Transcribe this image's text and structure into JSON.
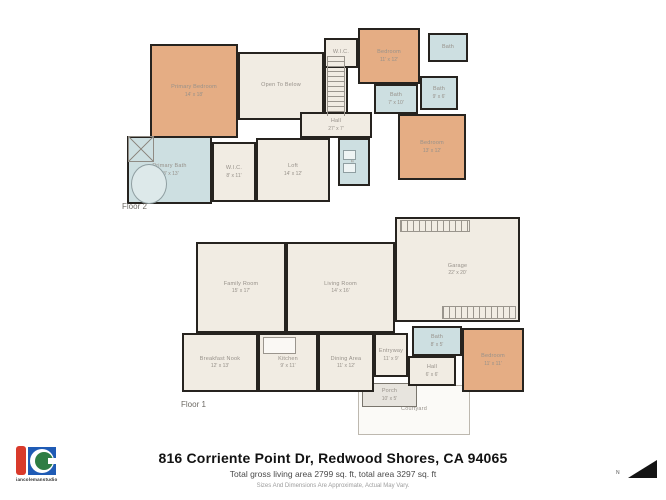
{
  "colors": {
    "wall": "#26231f",
    "bedroom": "#e5ad84",
    "bath": "#cddfe1",
    "common": "#f1ece3",
    "porch": "#e7e4de",
    "outdoor": "#fbfaf7",
    "label": "#97918a",
    "brand_red": "#d93a2b",
    "brand_blue": "#1f5bb5",
    "brand_green": "#2e7d44"
  },
  "title_block": {
    "address": "816 Corriente Point Dr, Redwood Shores, CA 94065",
    "area_line": "Total gross living area 2799 sq. ft, total area 3297 sq. ft",
    "disclaimer": "Sizes And Dimensions Are Approximate, Actual May Vary."
  },
  "branding": {
    "logo_text": "iancolemanstudio"
  },
  "compass": {
    "label": "N"
  },
  "floors": [
    {
      "id": "floor-2",
      "label": "Floor 2",
      "label_pos": [
        122,
        202
      ],
      "rooms": [
        {
          "id": "primary-bedroom",
          "name": "Primary Bedroom",
          "dims": "14' x 18'",
          "type": "bedroom",
          "rect": [
            150,
            44,
            88,
            94
          ]
        },
        {
          "id": "open-to-below",
          "name": "Open To Below",
          "dims": "",
          "type": "common",
          "rect": [
            238,
            52,
            86,
            68
          ]
        },
        {
          "id": "wic-top",
          "name": "W.I.C.",
          "dims": "",
          "type": "common",
          "rect": [
            324,
            38,
            34,
            30
          ]
        },
        {
          "id": "stair-well",
          "name": "",
          "dims": "",
          "type": "common",
          "rect": [
            324,
            66,
            24,
            54
          ]
        },
        {
          "id": "bedroom-2",
          "name": "Bedroom",
          "dims": "11' x 12'",
          "type": "bedroom",
          "rect": [
            358,
            28,
            62,
            56
          ]
        },
        {
          "id": "bath-top-right",
          "name": "Bath",
          "dims": "",
          "type": "bath",
          "rect": [
            428,
            33,
            40,
            29
          ]
        },
        {
          "id": "bath-left",
          "name": "Bath",
          "dims": "7' x 10'",
          "type": "bath",
          "rect": [
            374,
            84,
            44,
            30
          ]
        },
        {
          "id": "bath-right",
          "name": "Bath",
          "dims": "9' x 6'",
          "type": "bath",
          "rect": [
            420,
            76,
            38,
            34
          ]
        },
        {
          "id": "hall-f2",
          "name": "Hall",
          "dims": "27' x 7'",
          "type": "common",
          "rect": [
            300,
            112,
            72,
            26
          ]
        },
        {
          "id": "laundry",
          "name": "Laundry",
          "dims": "",
          "type": "bath",
          "rect": [
            338,
            138,
            32,
            48
          ],
          "vertical": true
        },
        {
          "id": "bedroom-3",
          "name": "Bedroom",
          "dims": "13' x 12'",
          "type": "bedroom",
          "rect": [
            398,
            114,
            68,
            66
          ]
        },
        {
          "id": "loft",
          "name": "Loft",
          "dims": "14' x 12'",
          "type": "common",
          "rect": [
            256,
            138,
            74,
            64
          ]
        },
        {
          "id": "wic-2",
          "name": "W.I.C.",
          "dims": "8' x 11'",
          "type": "common",
          "rect": [
            212,
            142,
            44,
            60
          ]
        },
        {
          "id": "primary-bath",
          "name": "Primary Bath",
          "dims": "13' x 13'",
          "type": "bath",
          "rect": [
            127,
            136,
            85,
            68
          ]
        }
      ]
    },
    {
      "id": "floor-1",
      "label": "Floor 1",
      "label_pos": [
        181,
        400
      ],
      "rooms": [
        {
          "id": "courtyard",
          "name": "Courtyard",
          "dims": "",
          "type": "outdoor",
          "rect": [
            358,
            385,
            112,
            50
          ]
        },
        {
          "id": "porch",
          "name": "Porch",
          "dims": "10' x 5'",
          "type": "porch",
          "rect": [
            362,
            383,
            55,
            24
          ]
        },
        {
          "id": "family-room",
          "name": "Family Room",
          "dims": "15' x 17'",
          "type": "common",
          "rect": [
            196,
            242,
            90,
            91
          ]
        },
        {
          "id": "living-room",
          "name": "Living Room",
          "dims": "14' x 16'",
          "type": "common",
          "rect": [
            286,
            242,
            109,
            91
          ]
        },
        {
          "id": "garage",
          "name": "Garage",
          "dims": "22' x 20'",
          "type": "common",
          "rect": [
            395,
            217,
            125,
            105
          ]
        },
        {
          "id": "breakfast-nook",
          "name": "Breakfast Nook",
          "dims": "12' x 13'",
          "type": "common",
          "rect": [
            182,
            333,
            76,
            59
          ]
        },
        {
          "id": "kitchen",
          "name": "Kitchen",
          "dims": "9' x 11'",
          "type": "common",
          "rect": [
            258,
            333,
            60,
            59
          ]
        },
        {
          "id": "dining-area",
          "name": "Dining Area",
          "dims": "11' x 12'",
          "type": "common",
          "rect": [
            318,
            333,
            56,
            59
          ]
        },
        {
          "id": "entryway",
          "name": "Entryway",
          "dims": "11' x 9'",
          "type": "common",
          "rect": [
            374,
            333,
            34,
            44
          ]
        },
        {
          "id": "bath-f1",
          "name": "Bath",
          "dims": "8' x 5'",
          "type": "bath",
          "rect": [
            412,
            326,
            50,
            30
          ]
        },
        {
          "id": "hall-f1",
          "name": "Hall",
          "dims": "6' x 6'",
          "type": "common",
          "rect": [
            408,
            356,
            48,
            30
          ]
        },
        {
          "id": "bedroom-f1",
          "name": "Bedroom",
          "dims": "11' x 11'",
          "type": "bedroom",
          "rect": [
            462,
            328,
            62,
            64
          ]
        }
      ]
    }
  ],
  "fixtures": [
    {
      "id": "skylight-x",
      "type": "xbox",
      "rect": [
        128,
        136,
        26,
        26
      ]
    },
    {
      "id": "bathtub",
      "type": "tub",
      "rect": [
        131,
        164,
        36,
        40
      ]
    },
    {
      "id": "stairs",
      "type": "stairs",
      "rect": [
        327,
        56,
        18,
        60
      ]
    },
    {
      "id": "washer",
      "type": "appliance",
      "rect": [
        343,
        150,
        13,
        10
      ]
    },
    {
      "id": "dryer",
      "type": "appliance",
      "rect": [
        343,
        163,
        13,
        10
      ]
    },
    {
      "id": "garage-storage-top",
      "type": "comb",
      "rect": [
        400,
        220,
        70,
        12
      ]
    },
    {
      "id": "garage-storage-bottom",
      "type": "comb",
      "rect": [
        442,
        306,
        74,
        13
      ]
    },
    {
      "id": "kitchen-island",
      "type": "island",
      "rect": [
        263,
        337,
        33,
        17
      ]
    }
  ]
}
